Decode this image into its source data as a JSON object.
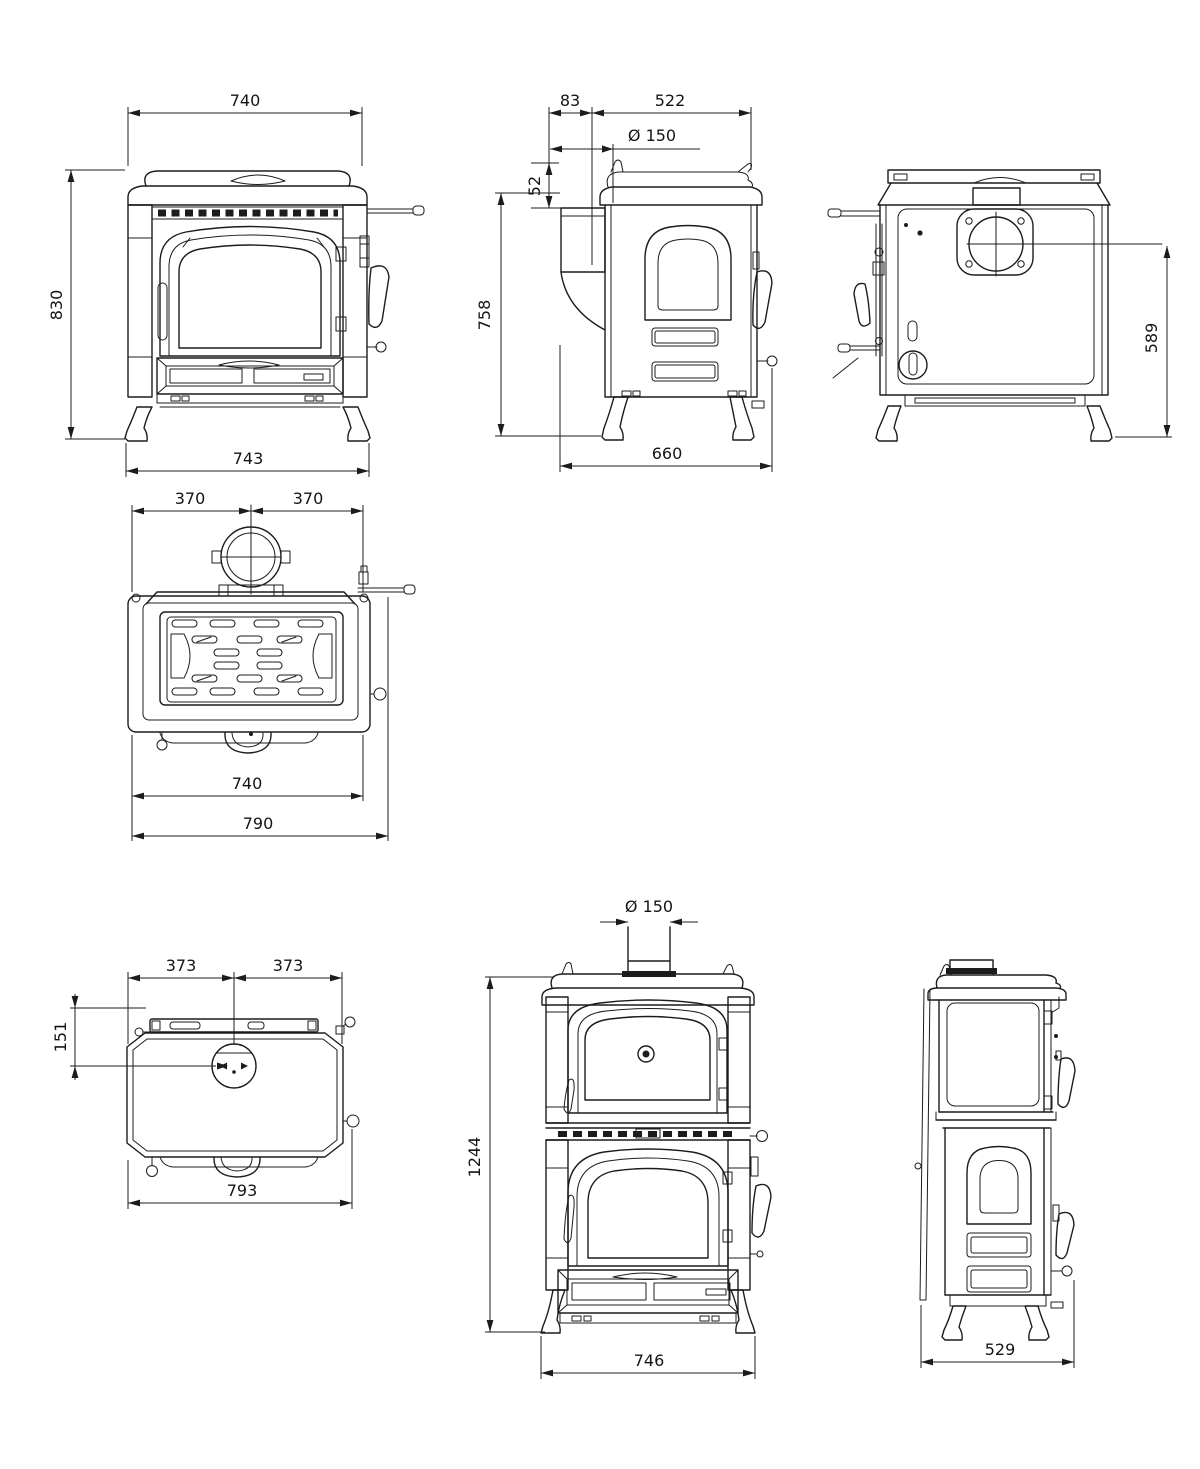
{
  "style": {
    "background": "#ffffff",
    "line_color": "#1c1c1c"
  },
  "views": {
    "front": {
      "top_width": "740",
      "height": "830",
      "base_width": "743"
    },
    "side": {
      "rear_offset": "83",
      "top_depth": "522",
      "flue_diameter": "Ø 150",
      "collar_drop": "52",
      "height": "758",
      "base_depth": "660"
    },
    "back": {
      "flue_center_height": "589"
    },
    "top": {
      "left_half": "370",
      "right_half": "370",
      "body_width": "740",
      "overall_width": "790"
    },
    "oven_top": {
      "left_half": "373",
      "right_half": "373",
      "flue_offset": "151",
      "overall_width": "793"
    },
    "oven_front": {
      "flue_diameter": "Ø 150",
      "overall_height": "1244",
      "base_width": "746"
    },
    "oven_side": {
      "base_depth": "529"
    }
  }
}
